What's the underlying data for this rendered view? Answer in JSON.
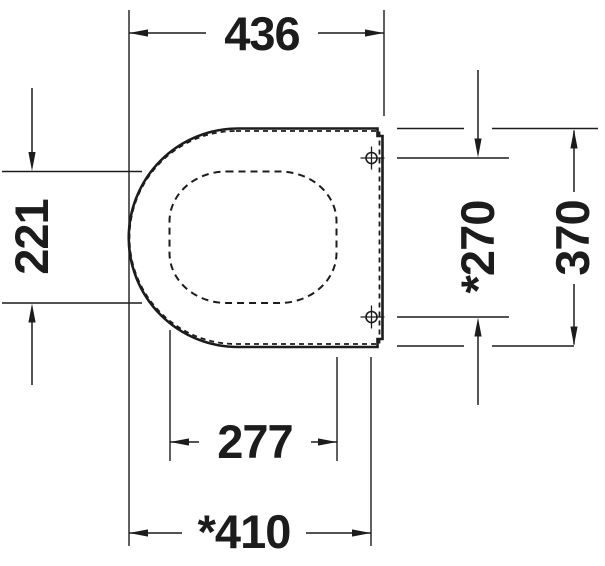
{
  "colors": {
    "line": "#1c1c1c",
    "background": "#ffffff"
  },
  "dimensions": {
    "overall_length": "436",
    "hole_width": "221",
    "hinge_spacing": "*270",
    "overall_width": "370",
    "hole_length": "277",
    "seat_length": "*410"
  }
}
